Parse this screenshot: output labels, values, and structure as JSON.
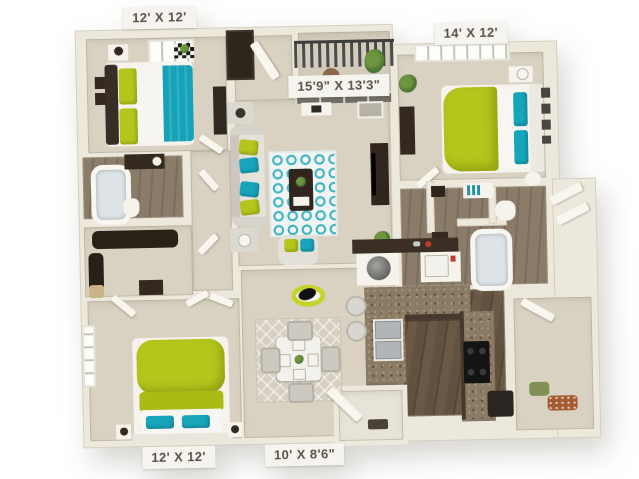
{
  "floorplan": {
    "dimension_labels": {
      "bedroom_top_left": "12' X 12'",
      "bedroom_top_right": "14' X 12'",
      "living_room": "15'9\" X 13'3\"",
      "bedroom_bottom_left": "12' X 12'",
      "dining_area": "10' X 8'6\""
    },
    "colors": {
      "background": "#ffffff",
      "walls": "#ece8dc",
      "carpet": "#d9d2c3",
      "wood_dark": "#63513f",
      "granite": "#8c7b64",
      "accent_teal": "#17a5bb",
      "accent_lime": "#b4c61c",
      "furniture_dark": "#33291f",
      "label_text": "#57534b",
      "label_background": "#f6f4ee"
    }
  }
}
